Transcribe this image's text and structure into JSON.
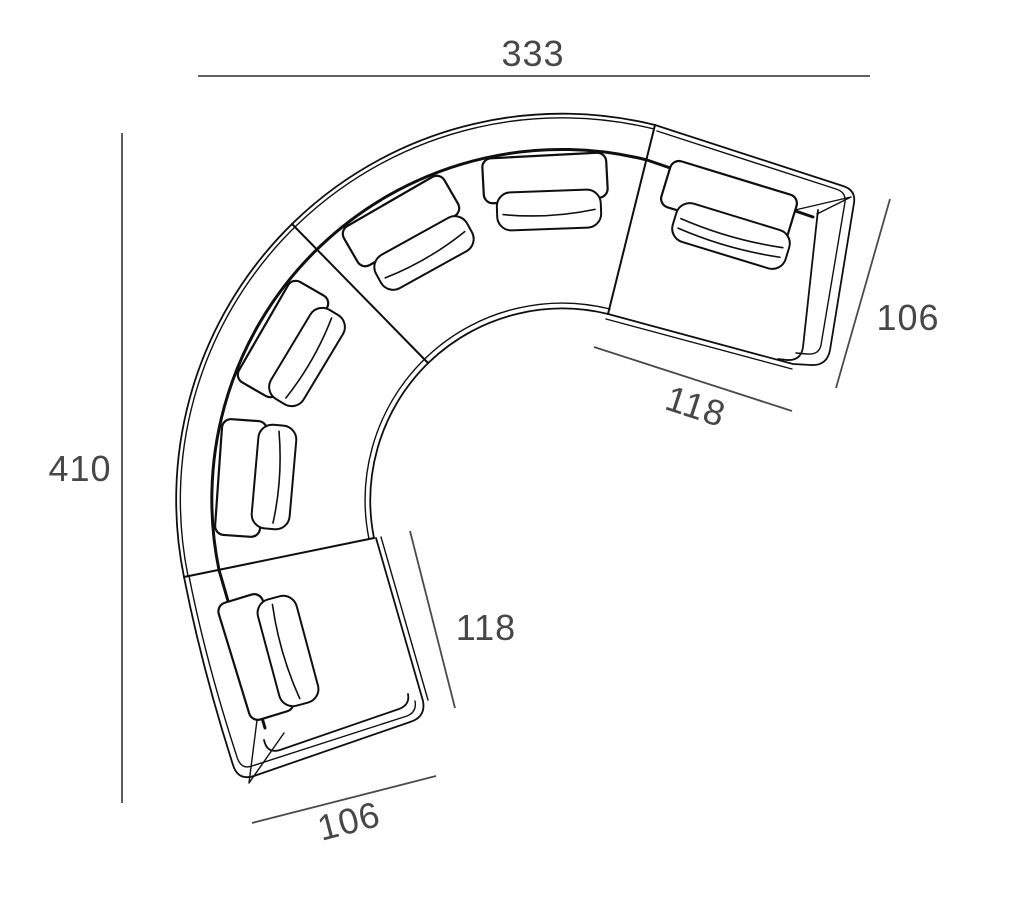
{
  "page": {
    "background": "#ffffff",
    "description": "Technical top-view dimension drawing of a curved modular sectional sofa"
  },
  "drawing": {
    "type": "furniture-floor-plan",
    "line_color": "#0f0f0f",
    "dimension_color": "#4a4a4a",
    "modules": [
      "right-arm-module",
      "curved-module-top",
      "curved-module-left",
      "bottom-arm-module"
    ]
  },
  "dims": {
    "overall_width": {
      "value": "333"
    },
    "overall_depth": {
      "value": "410"
    },
    "right_arm_depth": {
      "value": "106"
    },
    "right_module_width": {
      "value": "118"
    },
    "bottom_module_width": {
      "value": "118"
    },
    "bottom_arm_depth": {
      "value": "106"
    }
  }
}
